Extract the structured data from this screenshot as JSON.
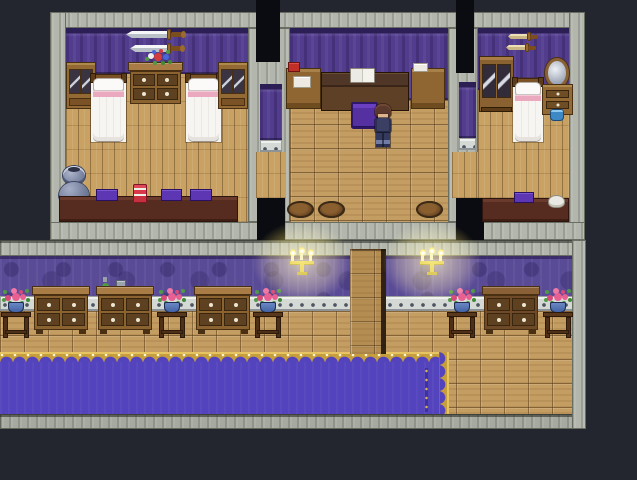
{
  "window": {
    "width": 637,
    "height": 480,
    "label": "RPG interior map — inn upper bedrooms and lower hallway"
  },
  "palette": {
    "bg": "#23262e",
    "void": "#0b0c11",
    "stone": "#b2b6ac",
    "stone_edge": "#6a6e62",
    "wall": "#523c8e",
    "wall_dark": "#2c1f56",
    "hall_wall": "#5a4b97",
    "plank": "#c9a263",
    "crate": "#c49d62",
    "column_wood": "#b48d52",
    "baseboard": "#d5d9d6",
    "carpet": "#5343bc",
    "carpet_gold": "#c69e3c",
    "wood_dark": "#5e4120",
    "furn": "#8a6330",
    "furn_light": "#a87c44",
    "furn_dark": "#4a3012",
    "table_dark": "#572c20",
    "bed_white": "#f6f5f2",
    "bed_pink": "#eba9bf",
    "glow": "#ffe66e",
    "flower_pink": "#e85f92",
    "leaf_green": "#4f9a44",
    "pot_blue": "#3f5d9e",
    "vase_gray": "#8791ad",
    "chair_purple": "#5530a0",
    "book_purple": "#5d36b4",
    "cake_red": "#d83848",
    "basin_blue": "#3e88c6",
    "char_hair": "#5a382c",
    "char_outfit": "#3a3f63"
  },
  "upper_floor": {
    "left_bedroom": {
      "label": "left bedroom",
      "wall_decor": [
        "mounted sword",
        "mounted sword"
      ],
      "furniture": [
        "glass cabinet",
        "bed",
        "flower dresser",
        "bed",
        "glass cabinet",
        "double vase",
        "long table"
      ],
      "table_items": [
        "purple book",
        "layer cake",
        "purple book",
        "purple book"
      ]
    },
    "study": {
      "label": "middle study",
      "furniture": [
        "supply shelf",
        "writing desk",
        "open book",
        "purple chair",
        "supply shelf"
      ],
      "rugs": [
        {
          "x": 287,
          "y": 201
        },
        {
          "x": 318,
          "y": 201
        },
        {
          "x": 416,
          "y": 201
        }
      ],
      "character": {
        "label": "hero sprite",
        "x": 374,
        "y": 104
      }
    },
    "right_bedroom": {
      "label": "right bedroom",
      "wall_decor": [
        "mounted dagger",
        "mounted dagger"
      ],
      "furniture": [
        "mirrored wardrobe",
        "bed",
        "vanity mirror",
        "wash basin",
        "long table"
      ],
      "table_items": [
        "purple book",
        "folded cloth"
      ]
    }
  },
  "hallway": {
    "label": "lower hallway",
    "dressers": [
      {
        "x": 32,
        "y": 286
      },
      {
        "x": 96,
        "y": 286
      },
      {
        "x": 194,
        "y": 286
      },
      {
        "x": 482,
        "y": 286,
        "dark": true
      }
    ],
    "flower_stands": [
      {
        "x": 1,
        "y": 285
      },
      {
        "x": 157,
        "y": 285
      },
      {
        "x": 253,
        "y": 285
      },
      {
        "x": 447,
        "y": 285
      },
      {
        "x": 543,
        "y": 285
      }
    ],
    "candelabras": [
      {
        "x": 289,
        "y": 248
      },
      {
        "x": 419,
        "y": 248
      }
    ],
    "wall_items": [
      "hanging plant",
      "wall plaque"
    ],
    "carpet": {
      "color": "#5343bc",
      "trim": "#c69e3c"
    }
  }
}
